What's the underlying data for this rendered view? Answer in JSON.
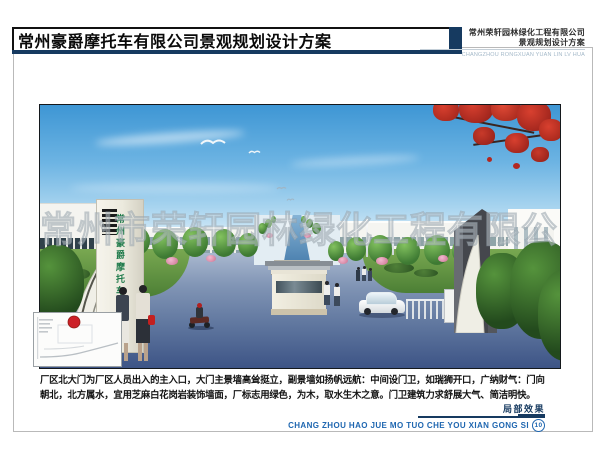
{
  "page": {
    "title": "常州豪爵摩托车有限公司景观规划设计方案",
    "firm": {
      "name": "常州荣轩园林绿化工程有限公司",
      "subtitle": "景观规划设计方案",
      "pinyin": "CHANGZHOU RONGXUAN YUAN LIN LV HUA"
    }
  },
  "rendering": {
    "watermark": "常州市荣轩园林绿化工程有限公司",
    "gate_sign": "常州豪爵摩托车有限公司"
  },
  "description": {
    "line1": "厂区北大门为厂区人员出入的主入口，大门主景墙高耸挺立，副景墙如扬帆远航：中间设门卫，如瑞狮开口，广纳财气：门向",
    "line2": "朝北，北方属水，宜用芝麻白花岗岩装饰墙面，厂标志用绿色，为木，取水生木之意。门卫建筑力求舒展大气、简洁明快。"
  },
  "footer": {
    "caption": "局部效果",
    "pinyin": "CHANG ZHOU HAO JUE MO TUO CHE YOU XIAN GONG SI",
    "page_number": "10"
  },
  "colors": {
    "navy_bar": "#163a60",
    "footer_blue": "#1e66b0",
    "header_pinyin_gray": "#a4b9c9",
    "gate_sign_green": "#1e7a4a",
    "stamp_red": "#cc2027"
  }
}
